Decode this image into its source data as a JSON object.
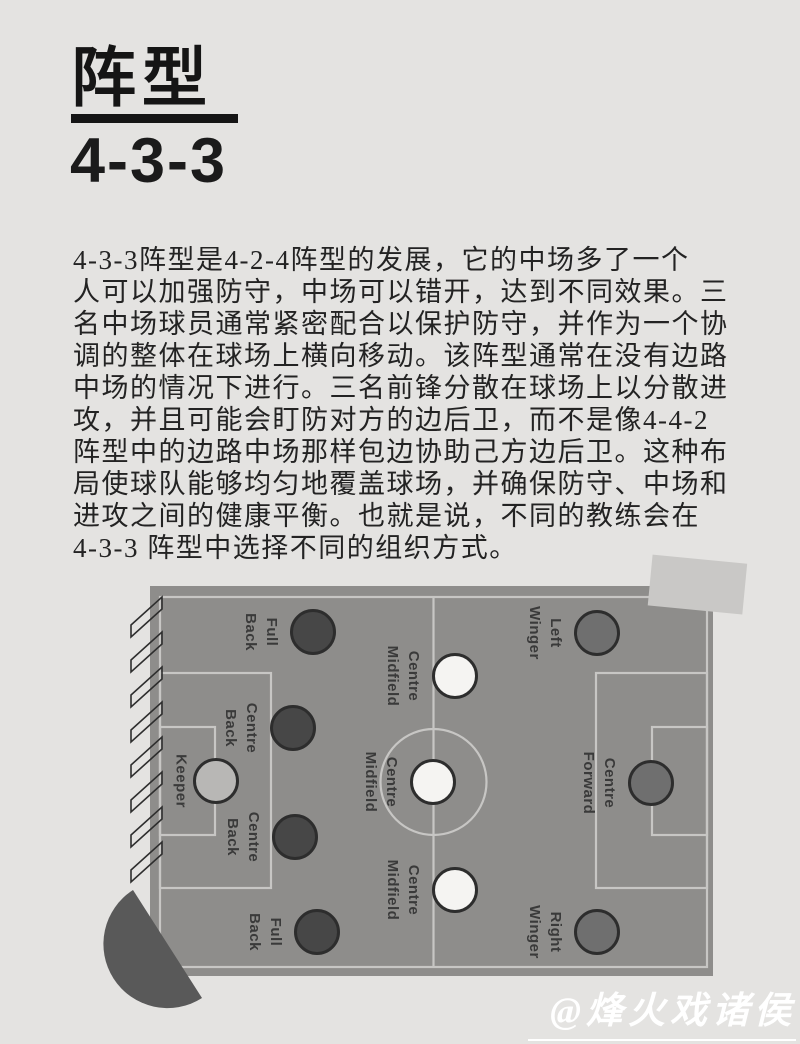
{
  "header": {
    "title": "阵型",
    "subtitle": "4-3-3"
  },
  "article": {
    "lines": [
      "4-3-3阵型是4-2-4阵型的发展，它的中场多了一个",
      "人可以加强防守，中场可以错开，达到不同效果。三",
      "名中场球员通常紧密配合以保护防守，并作为一个协",
      "调的整体在球场上横向移动。该阵型通常在没有边路",
      "中场的情况下进行。三名前锋分散在球场上以分散进",
      "攻，并且可能会盯防对方的边后卫，而不是像4-4-2",
      "阵型中的边路中场那样包边协助己方边后卫。这种布",
      "局使球队能够均匀地覆盖球场，并确保防守、中场和",
      "进攻之间的健康平衡。也就是说，不同的教练会在",
      "4-3-3 阵型中选择不同的组织方式。"
    ]
  },
  "formation": {
    "name": "4-3-3",
    "players": [
      {
        "id": "keeper",
        "line1": "Keeper",
        "line2": ""
      },
      {
        "id": "centre-back-1",
        "line1": "Centre",
        "line2": "Back"
      },
      {
        "id": "centre-back-2",
        "line1": "Centre",
        "line2": "Back"
      },
      {
        "id": "full-back-1",
        "line1": "Full",
        "line2": "Back"
      },
      {
        "id": "full-back-2",
        "line1": "Full",
        "line2": "Back"
      },
      {
        "id": "centre-mid-1",
        "line1": "Centre",
        "line2": "Midfield"
      },
      {
        "id": "centre-mid-2",
        "line1": "Centre",
        "line2": "Midfield"
      },
      {
        "id": "centre-mid-3",
        "line1": "Centre",
        "line2": "Midfield"
      },
      {
        "id": "left-winger",
        "line1": "Left",
        "line2": "Winger"
      },
      {
        "id": "centre-forward",
        "line1": "Centre",
        "line2": "Forward"
      },
      {
        "id": "right-winger",
        "line1": "Right",
        "line2": "Winger"
      }
    ]
  },
  "watermark": {
    "text": "@烽火戏诸侯"
  },
  "colors": {
    "page_bg": "#e4e3e1",
    "pitch": "#8e8d8b",
    "pitch_line": "#c7c6c4",
    "player_dark": "#474747",
    "player_medium": "#6f6f6f",
    "player_white": "#f5f4f2",
    "player_keeper": "#b8b7b5",
    "fan_shape": "#595959",
    "deco_rect": "#c9c8c6",
    "text": "#232323",
    "watermark": "#ffffff"
  }
}
